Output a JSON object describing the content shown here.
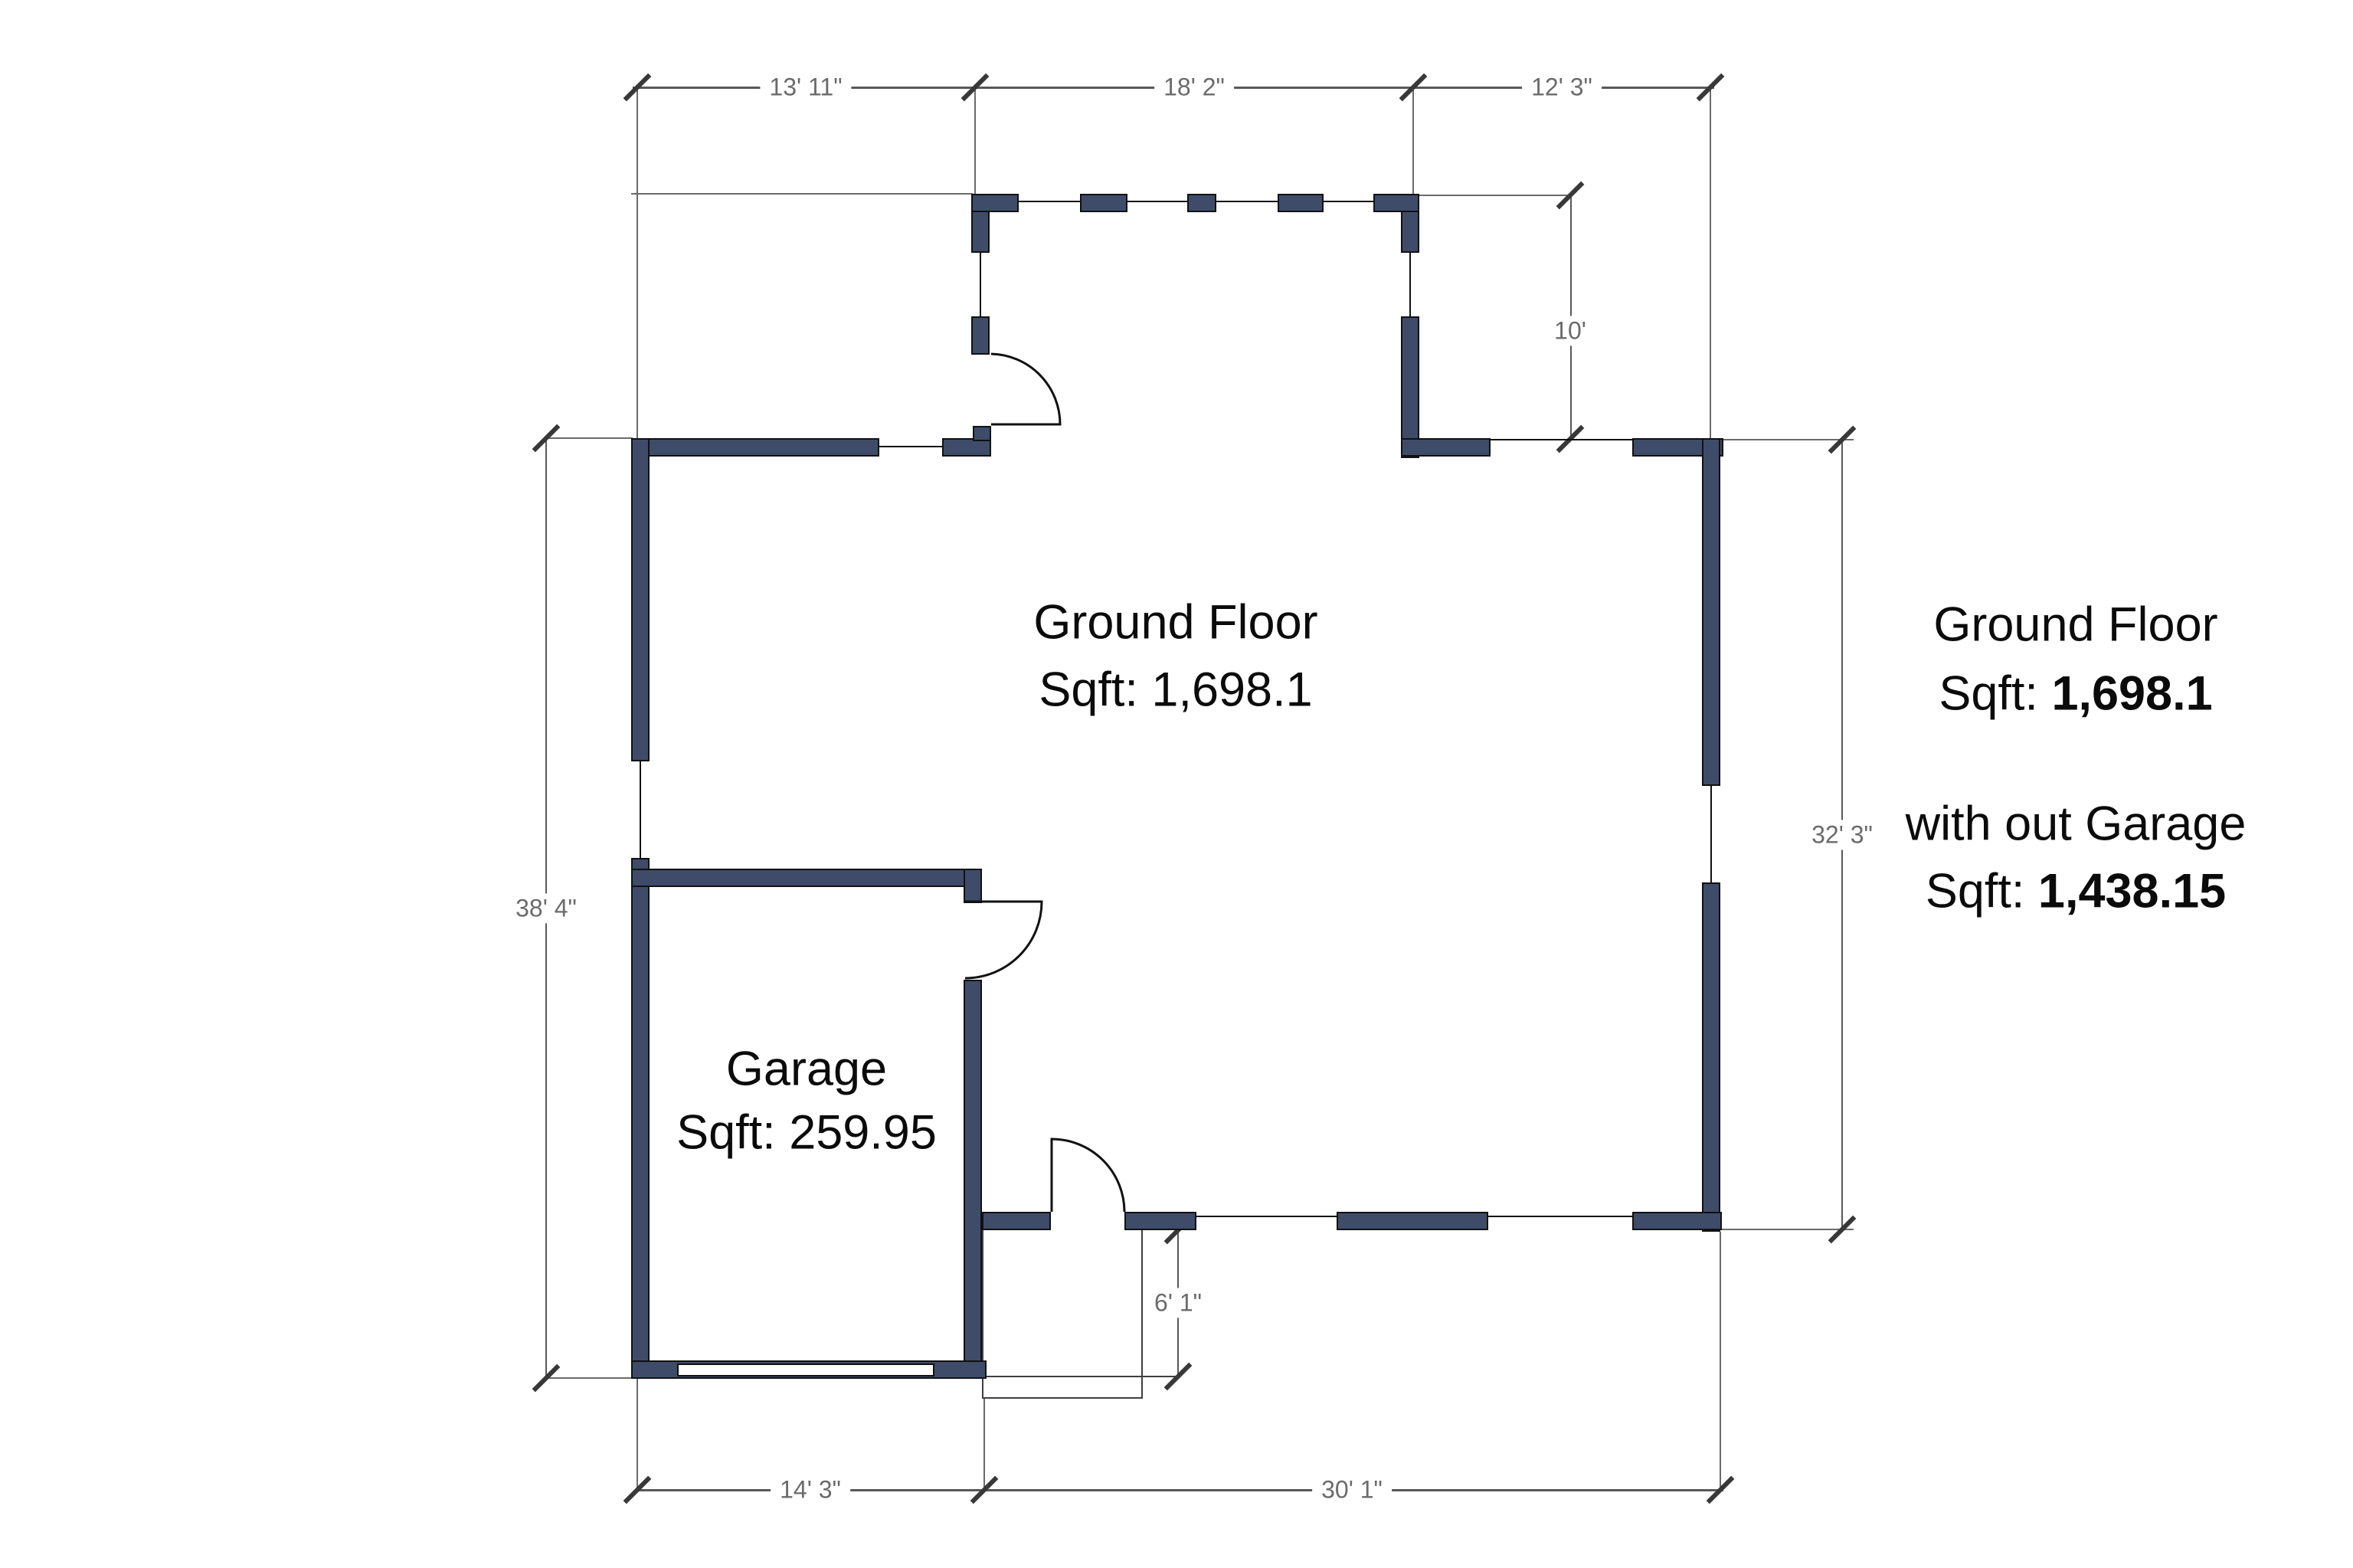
{
  "colors": {
    "wall_fill": "#3e4c6a",
    "wall_outline": "#111111",
    "dimension_line": "#585858",
    "dimension_text": "#6b6b6b",
    "label_text": "#0b0b0b",
    "background": "#ffffff"
  },
  "dimensions": {
    "top": [
      {
        "label": "13' 11\""
      },
      {
        "label": "18' 2\""
      },
      {
        "label": "12' 3\""
      }
    ],
    "recess_depth": {
      "label": "10'"
    },
    "left_height": {
      "label": "38' 4\""
    },
    "right_height": {
      "label": "32' 3\""
    },
    "bottom": [
      {
        "label": "14' 3\""
      },
      {
        "label": "30' 1\""
      }
    ],
    "porch_depth": {
      "label": "6' 1\""
    }
  },
  "rooms": {
    "ground_floor": {
      "name": "Ground Floor",
      "sqft": "Sqft: 1,698.1"
    },
    "garage": {
      "name": "Garage",
      "sqft": "Sqft: 259.95"
    }
  },
  "summary": {
    "title": "Ground Floor",
    "sqft_prefix": "Sqft: ",
    "sqft_value": "1,698.1",
    "subtitle": "with out Garage",
    "sqft2_prefix": "Sqft: ",
    "sqft2_value": "1,438.15"
  }
}
